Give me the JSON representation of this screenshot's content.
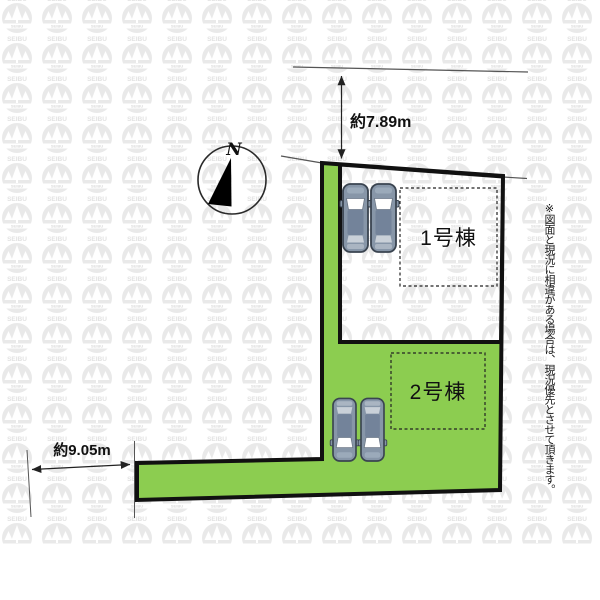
{
  "site_plan": {
    "compass_label": "N",
    "dimension_top": "約7.89m",
    "dimension_bottom_left": "約9.05m",
    "buildings": [
      {
        "label": "1号棟"
      },
      {
        "label": "2号棟"
      }
    ],
    "disclaimer_note": "※図面と現況に相違がある場合は、現況優先とさせて頂きます。"
  },
  "watermark": {
    "logo_text": "SEIBU",
    "logo_subtext": "SEIBU"
  },
  "colors": {
    "lot_green": "#8ccd50",
    "outline": "#111111",
    "road_line": "#555555",
    "car_body": "#8796a8",
    "car_roof": "#73839a",
    "car_window": "#ffffff",
    "watermark_gray": "#e9e9e9"
  }
}
